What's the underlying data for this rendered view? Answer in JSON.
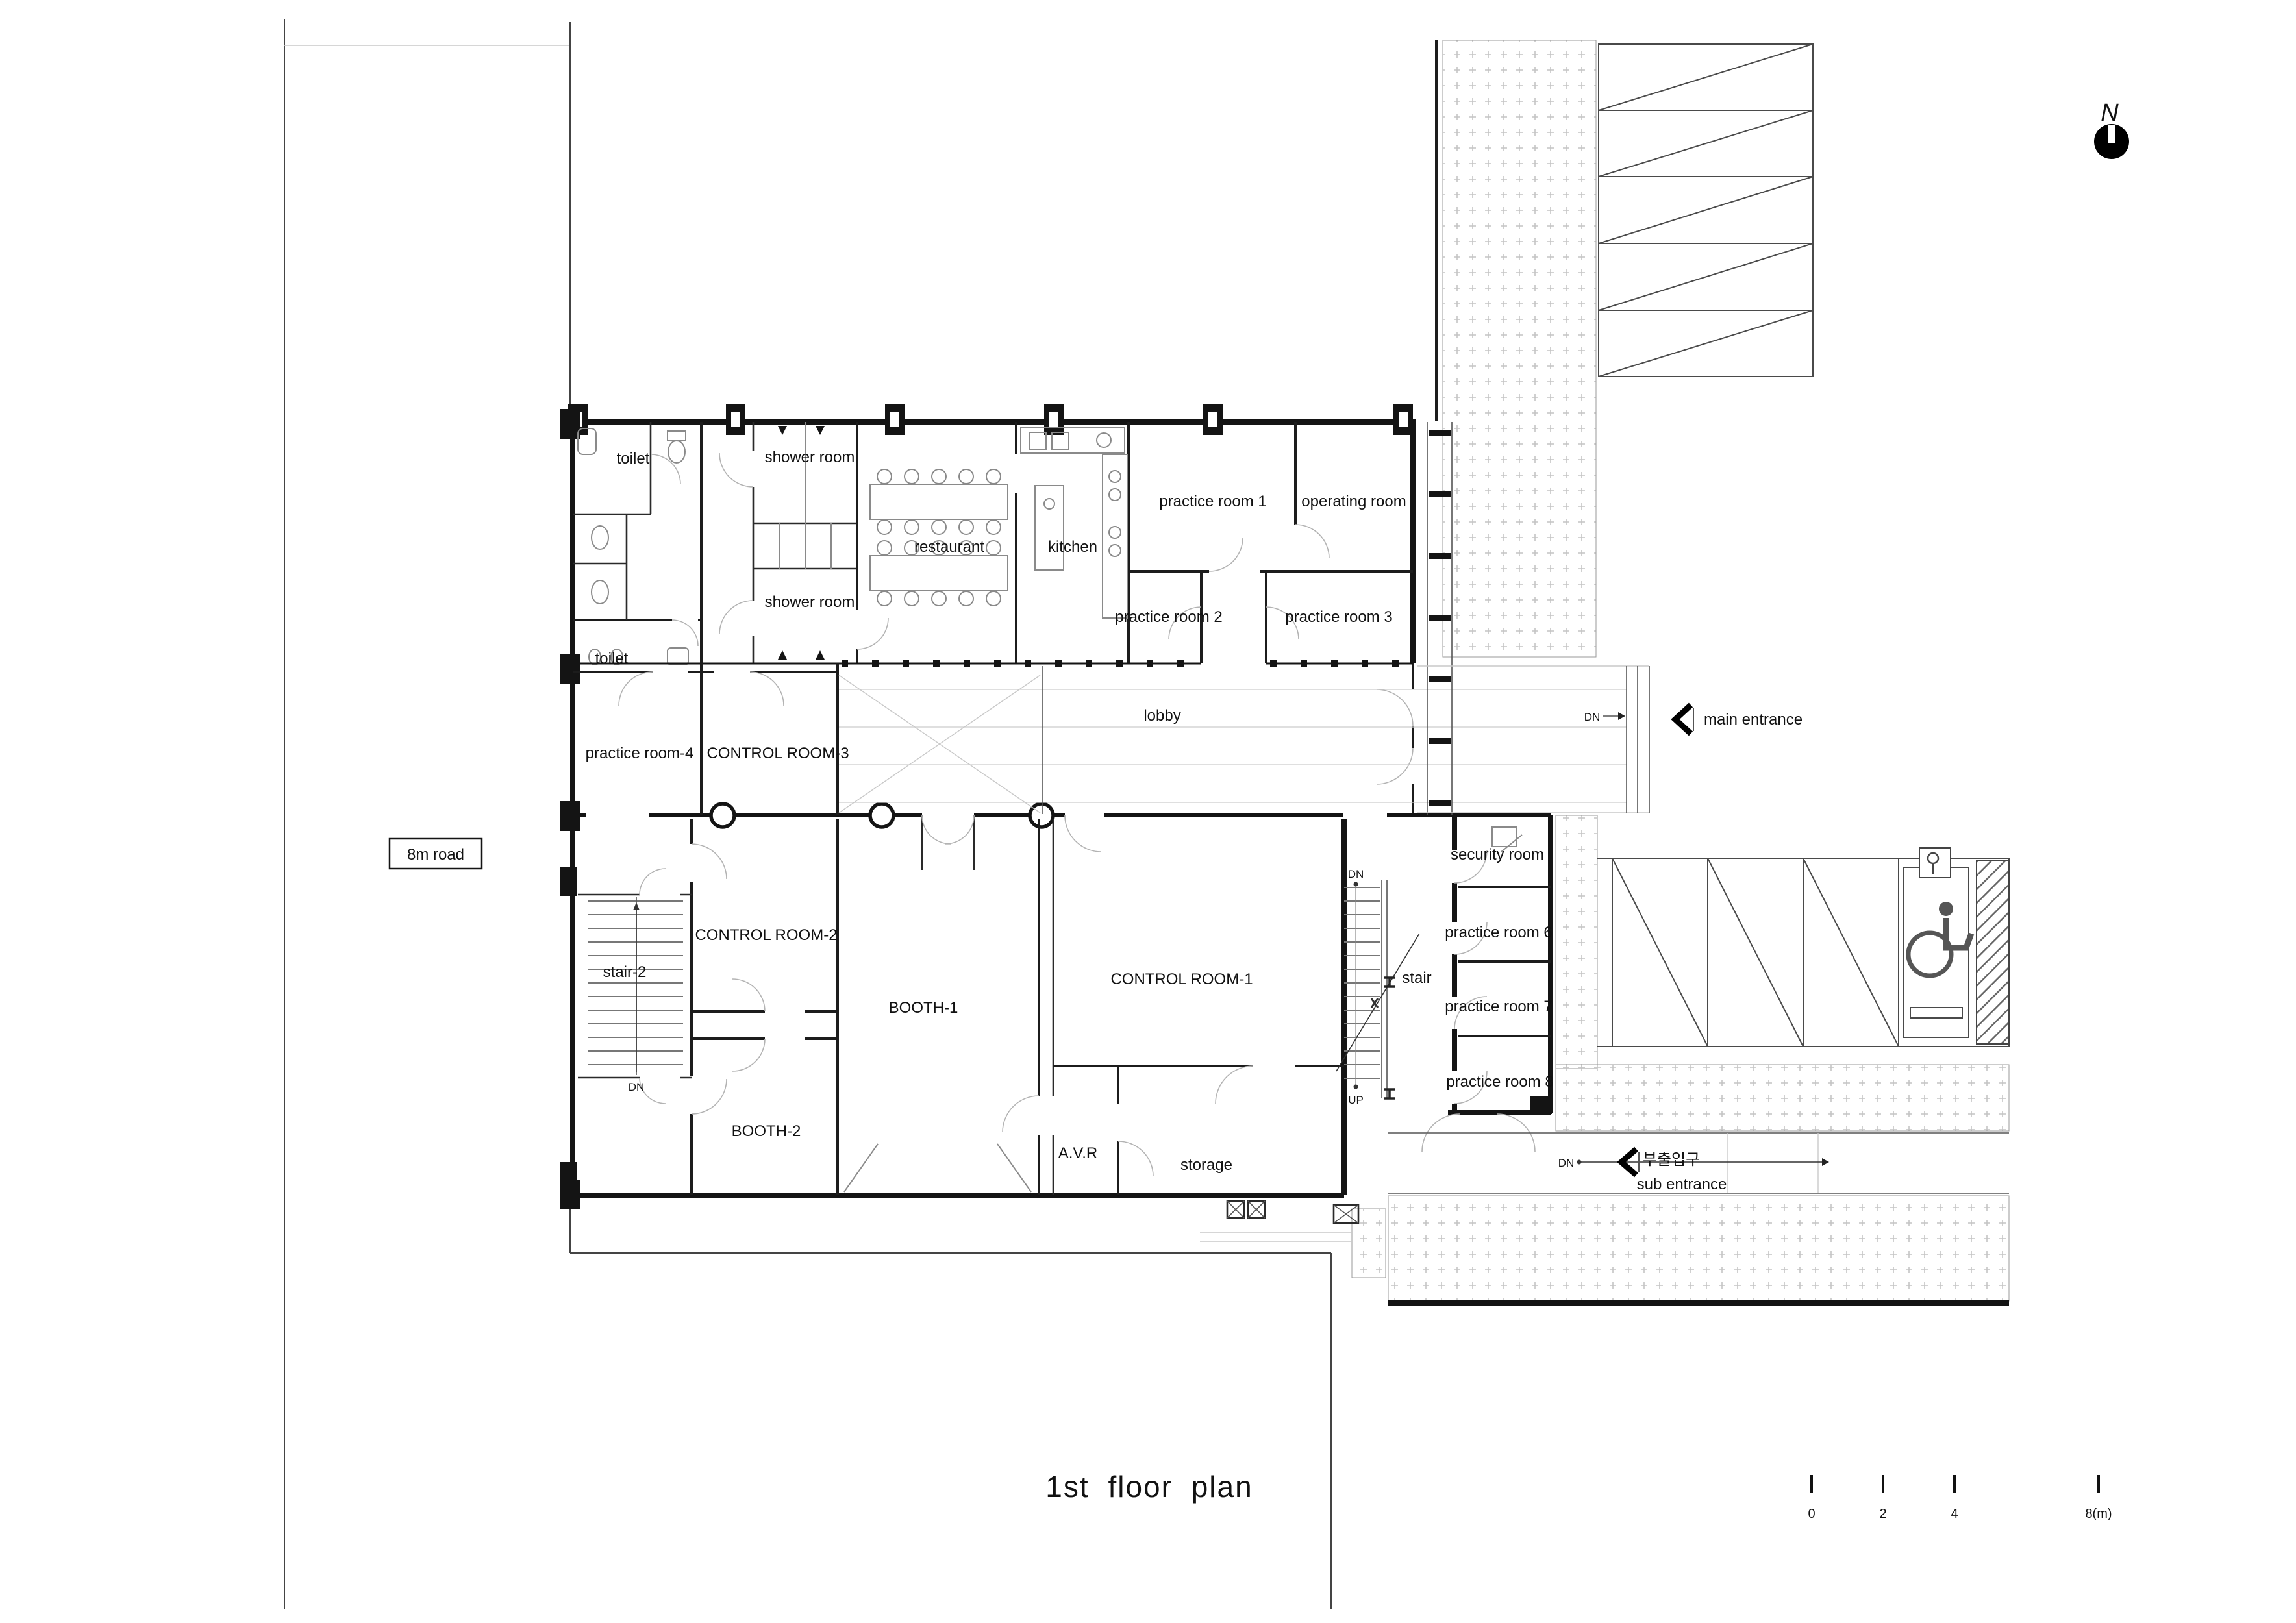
{
  "drawing": {
    "type": "architectural floor plan",
    "colors": {
      "ink": "#141414",
      "light_line": "#cccccc",
      "stipple": "#c4c4c4",
      "paper": "#ffffff"
    }
  },
  "labels": {
    "toilet_top": {
      "text": "toilet"
    },
    "shower_room_top": {
      "text": "shower room"
    },
    "restaurant": {
      "text": "restaurant"
    },
    "kitchen": {
      "text": "kitchen"
    },
    "practice_room_1": {
      "text": "practice room 1"
    },
    "operating_room": {
      "text": "operating room"
    },
    "practice_room_2": {
      "text": "practice room 2"
    },
    "practice_room_3": {
      "text": "practice room 3"
    },
    "shower_room_bot": {
      "text": "shower room"
    },
    "toilet_bottom": {
      "text": "toilet"
    },
    "practice_room_4": {
      "text": "practice room-4"
    },
    "control_room_3": {
      "text": "CONTROL ROOM-3"
    },
    "lobby": {
      "text": "lobby"
    },
    "dn_main": {
      "text": "DN"
    },
    "main_entrance": {
      "text": "main entrance"
    },
    "road_8m": {
      "text": "8m road"
    },
    "security_room": {
      "text": "security room"
    },
    "control_room_2": {
      "text": "CONTROL ROOM-2"
    },
    "stair_2": {
      "text": "stair-2"
    },
    "booth_1": {
      "text": "BOOTH-1"
    },
    "control_room_1": {
      "text": "CONTROL ROOM-1"
    },
    "stair_main": {
      "text": "stair"
    },
    "practice_room_6": {
      "text": "practice room 6"
    },
    "practice_room_7": {
      "text": "practice room 7"
    },
    "practice_room_8": {
      "text": "practice room 8"
    },
    "booth_2": {
      "text": "BOOTH-2"
    },
    "avr": {
      "text": "A.V.R"
    },
    "storage": {
      "text": "storage"
    },
    "dn_stair2": {
      "text": "DN"
    },
    "dn_stair_main": {
      "text": "DN"
    },
    "up_stair_main": {
      "text": "UP"
    },
    "dn_sub": {
      "text": "DN"
    },
    "sub_korean": {
      "text": "부출입구"
    },
    "sub_entrance": {
      "text": "sub entrance"
    },
    "title": {
      "text": "1st floor plan"
    },
    "scale_0": {
      "text": "0"
    },
    "scale_2": {
      "text": "2"
    },
    "scale_4": {
      "text": "4"
    },
    "scale_8": {
      "text": "8(m)"
    },
    "north": {
      "text": "N"
    }
  }
}
